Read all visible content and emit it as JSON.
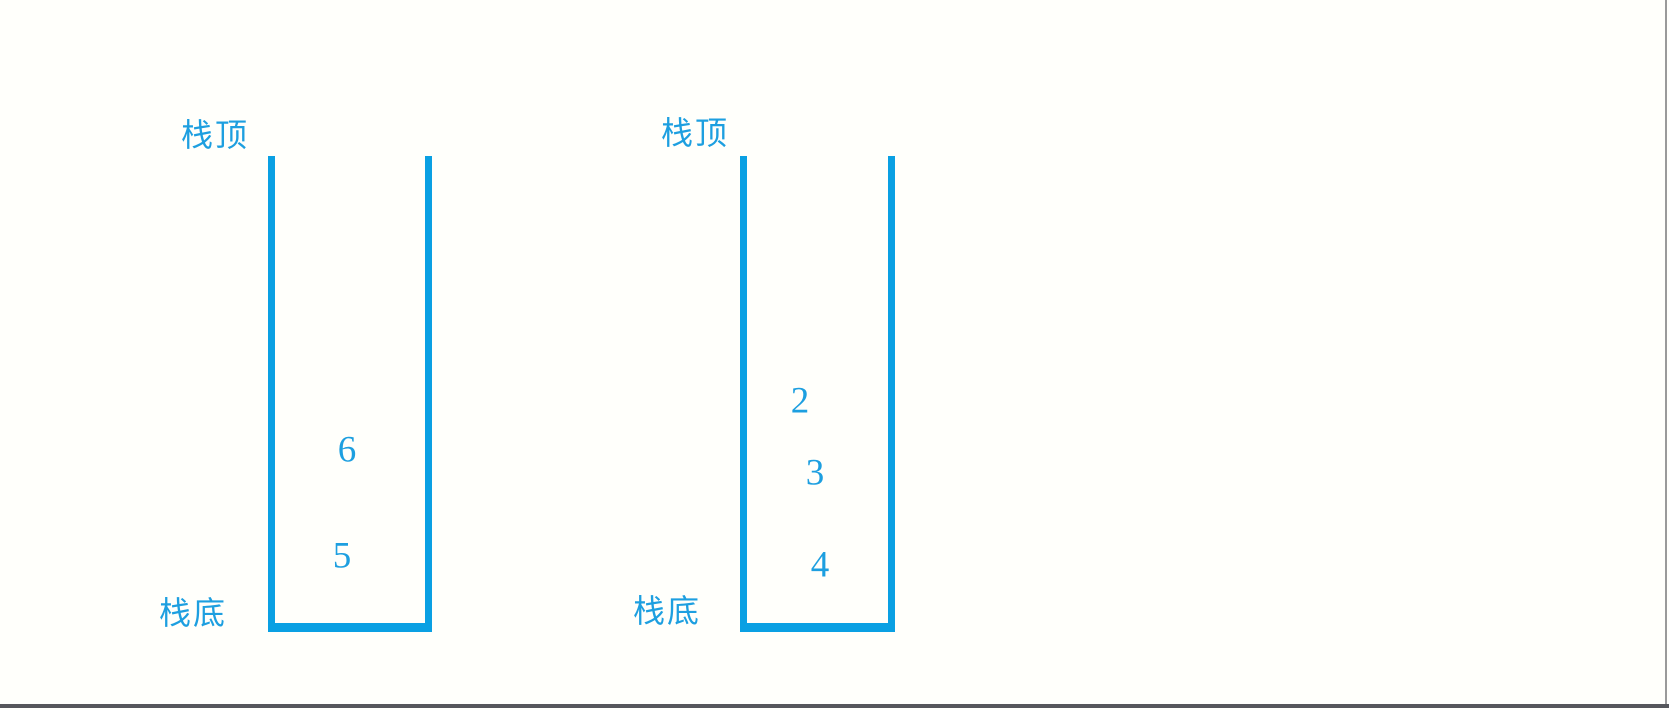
{
  "page": {
    "background_color": "#fffffb",
    "bottom_rule_color": "#56575b",
    "right_rule_color": "#9a9a9a"
  },
  "diagram": {
    "accent_color": "#0aa0e3",
    "text_color": "#1d9fe0",
    "stacks": [
      {
        "top_label": "栈顶",
        "bottom_label": "栈底",
        "items": [
          "6",
          "5"
        ]
      },
      {
        "top_label": "栈顶",
        "bottom_label": "栈底",
        "items": [
          "2",
          "3",
          "4"
        ]
      }
    ]
  }
}
